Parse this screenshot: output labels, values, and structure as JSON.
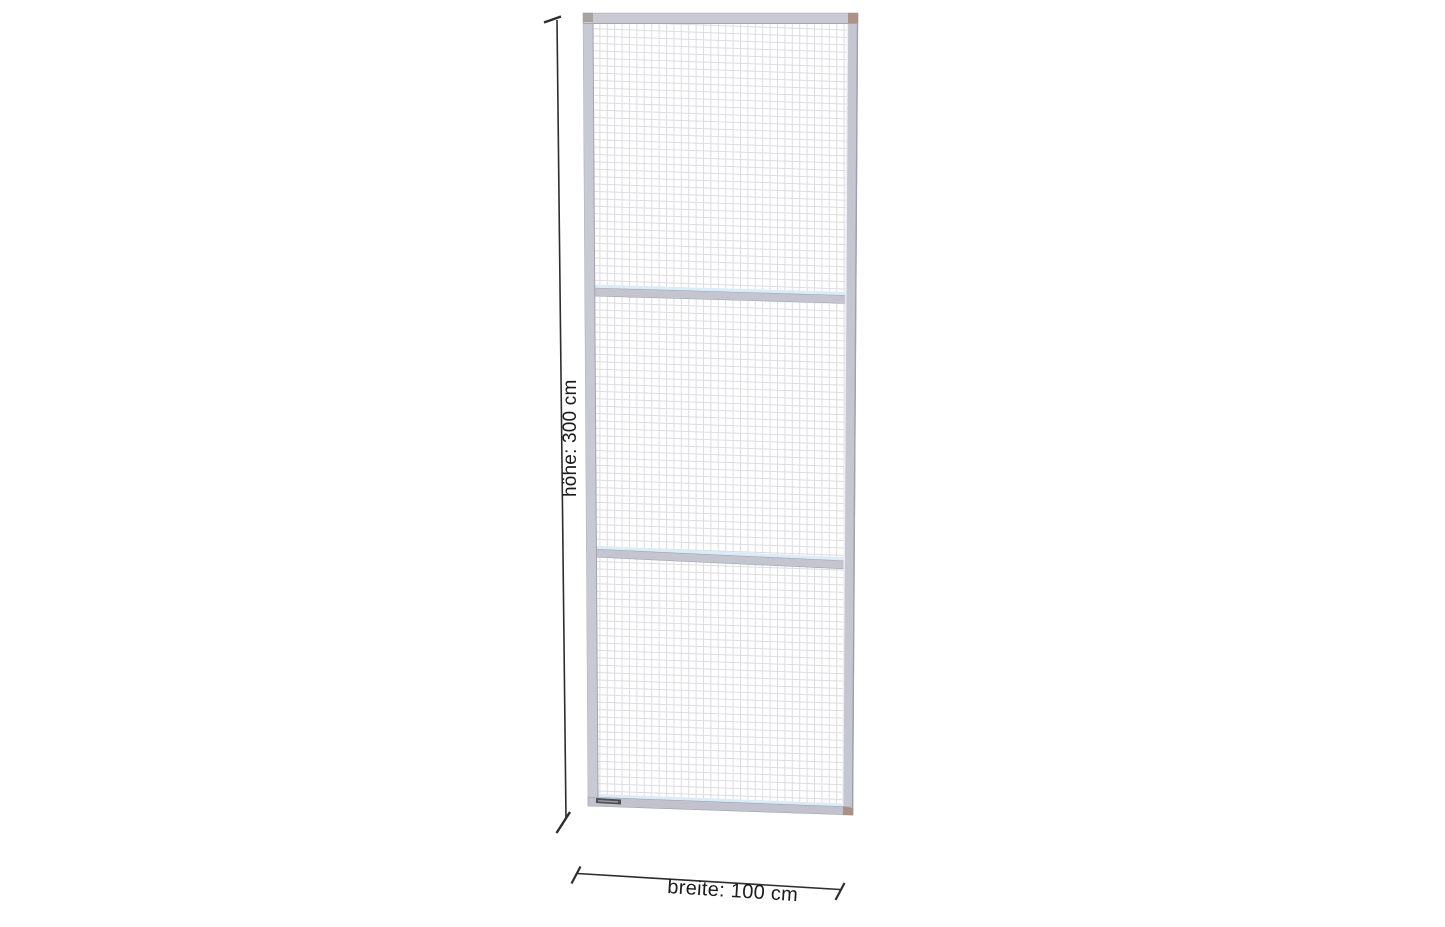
{
  "page": {
    "background": "#ffffff"
  },
  "diagram": {
    "type": "product-dimension-drawing",
    "subject": "wire-mesh-partition-panel",
    "panel": {
      "sections_count": 3,
      "mesh_style": "fine-wire-grid",
      "height_label": "höhe: 300 cm",
      "width_label": "breite: 100 cm",
      "height_value_cm": 300,
      "width_value_cm": 100
    },
    "colors": {
      "frame": "#c8c8d2",
      "frame_dark_edge": "#a3a3b1",
      "frame_light_edge": "#edeff4",
      "mesh_line": "#d4d4da",
      "panel_background": "#ffffff",
      "rail_highlight": "#d9ecf8",
      "corner_cap_tan": "#ab9282",
      "corner_cap_gray": "#a9a19b",
      "label_plate": "#4e4e52",
      "dimension_line": "#2d2d2d",
      "text": "#1c1c1c"
    }
  }
}
